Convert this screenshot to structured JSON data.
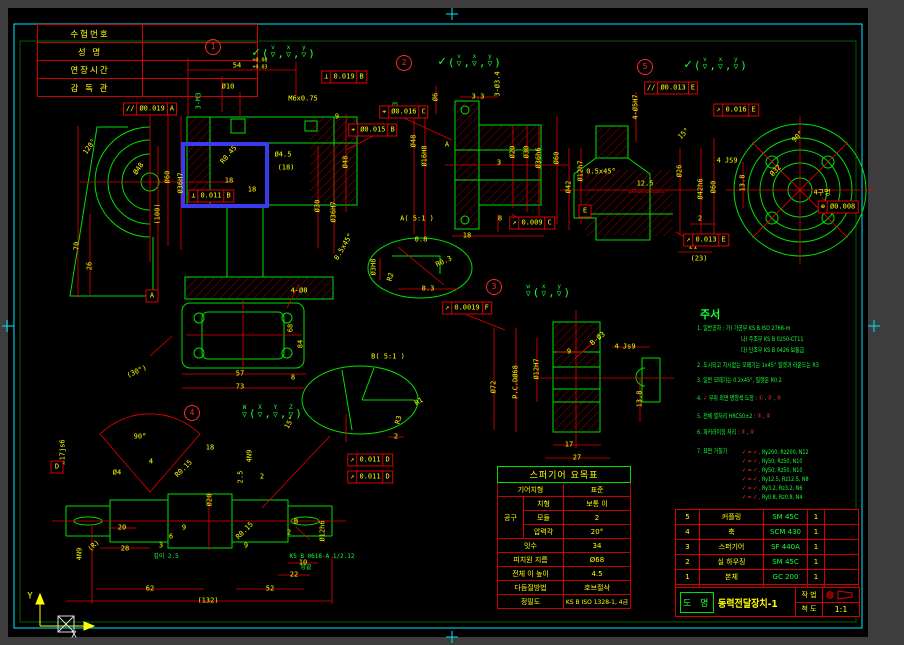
{
  "sheet": {
    "outer_bg": "#3d3d3d",
    "paper_bg": "#000000",
    "frame_color": "#00e5ff",
    "geometry_color": "#00e000",
    "dimension_color": "#e60000",
    "text_color": "#ffff00",
    "note_color": "#15ff35",
    "highlight_color": "#3a3aee"
  },
  "exam_table": {
    "rows": [
      {
        "label": "수험번호",
        "value": ""
      },
      {
        "label": "성  명",
        "value": ""
      },
      {
        "label": "연장시간",
        "value": ""
      },
      {
        "label": "감 독 관",
        "value": ""
      }
    ]
  },
  "ucs": {
    "y_label": "Y",
    "x_label": "X"
  },
  "notes": {
    "title": "주서",
    "title_x": 700,
    "title_y": 314,
    "lines": [
      {
        "t": "1. 일반공차 : 가) 가공부 KS B ISO 2768-m",
        "x": 697,
        "y": 328
      },
      {
        "t": "나) 주조부 KS B 0250-CT11",
        "x": 741,
        "y": 339
      },
      {
        "t": "다) 단조부 KS B 0426 보통급",
        "x": 741,
        "y": 350
      },
      {
        "t": "2. 도시되고 지시없는 모떼기는 1x45° 필렛과 라운드는 R3",
        "x": 697,
        "y": 365
      },
      {
        "t": "3. 일반 모떼기는 0.2x45°, 필렛은 R0.2",
        "x": 697,
        "y": 380
      },
      {
        "t": "4. ✓ 부위 외면 명청색 도장 : ① , ② , ③",
        "x": 697,
        "y": 398
      },
      {
        "t": "5. 전체 열처리 HRC50±2 : ③ , ④",
        "x": 697,
        "y": 416
      },
      {
        "t": "6. 파커라이징 처리 : ③ , ④",
        "x": 697,
        "y": 432
      },
      {
        "t": "7. 표면 거칠기",
        "x": 697,
        "y": 451
      }
    ],
    "roughness": [
      {
        "sym": "✓ = ✓ ,",
        "val": "Ry200, Rz200, N12",
        "x": 742,
        "y": 452
      },
      {
        "sym": "✓ = ✓ ,",
        "val": "Ry50,  Rz50,  N10",
        "x": 742,
        "y": 461
      },
      {
        "sym": "✓ = ✓ ,",
        "val": "Ry50,  Rz50,  N10",
        "x": 742,
        "y": 470
      },
      {
        "sym": "✓ = ✓ ,",
        "val": "Ry12.5, Rz12.5, N8",
        "x": 742,
        "y": 479
      },
      {
        "sym": "✓ = ✓ ,",
        "val": "Ry3.2, Rz3.2, N6",
        "x": 742,
        "y": 488
      },
      {
        "sym": "✓ = ✓ ,",
        "val": "Ry0.8, Rz0.8, N4",
        "x": 742,
        "y": 497
      }
    ]
  },
  "gear_table": {
    "title": "스퍼기어 요목표",
    "type_label": "기어치형",
    "type_value": "표준",
    "tool_label": "공구",
    "tooth_label": "치형",
    "tooth_value": "보통 이",
    "module_label": "모듈",
    "module_value": "2",
    "pressure_label": "압력각",
    "pressure_value": "20°",
    "teeth_label": "잇수",
    "teeth_value": "34",
    "pcd_label": "피치원 지름",
    "pcd_value": "Ø68",
    "height_label": "전체 이 높이",
    "height_value": "4.5",
    "finish_label": "다듬질방법",
    "finish_value": "호브절삭",
    "precision_label": "정밀도",
    "precision_value": "KS B ISO 1328-1, 4급"
  },
  "bom": {
    "headers": [
      "품 번",
      "품 명",
      "재 질",
      "수 량",
      "비 고"
    ],
    "items": [
      {
        "no": "5",
        "name": "커플링",
        "mat": "SM 45C",
        "qty": "1",
        "remark": ""
      },
      {
        "no": "4",
        "name": "축",
        "mat": "SCM 430",
        "qty": "1",
        "remark": ""
      },
      {
        "no": "3",
        "name": "스퍼기어",
        "mat": "SF 440A",
        "qty": "1",
        "remark": ""
      },
      {
        "no": "2",
        "name": "실 하우징",
        "mat": "SM 45C",
        "qty": "1",
        "remark": ""
      },
      {
        "no": "1",
        "name": "본체",
        "mat": "GC 200",
        "qty": "1",
        "remark": ""
      }
    ],
    "drawing_name_label": "도 명",
    "drawing_name": "동력전달장치-1",
    "method_label": "작 법",
    "scale_label": "척 도",
    "scale_value": "1:1"
  },
  "views": [
    {
      "name": "view-1",
      "balloon": {
        "n": "1",
        "x": 213,
        "y": 47
      },
      "finish": {
        "x": 284,
        "y": 52,
        "base": "",
        "letters": [
          "v",
          "x",
          "y"
        ]
      },
      "datums": [
        {
          "t": "A",
          "x": 152,
          "y": 296
        }
      ],
      "fcf": [
        {
          "x": 344,
          "y": 77,
          "cells": [
            "⊥",
            "0.019",
            "B"
          ]
        },
        {
          "x": 150,
          "y": 109,
          "cells": [
            "//",
            "Ø0.019",
            "A"
          ]
        },
        {
          "x": 373,
          "y": 130,
          "cells": [
            "⌖",
            "Ø0.015",
            "B"
          ]
        },
        {
          "x": 211,
          "y": 196,
          "cells": [
            "⊥",
            "0.011",
            "B"
          ]
        }
      ],
      "labels": [
        {
          "t": "54",
          "x": 237,
          "y": 66
        },
        {
          "t": "+0.08",
          "x": 260,
          "y": 61,
          "s": 5
        },
        {
          "t": "+0.03",
          "x": 260,
          "y": 68,
          "s": 5
        },
        {
          "t": "Ø10",
          "x": 228,
          "y": 87
        },
        {
          "t": "M6x0.75",
          "x": 303,
          "y": 99
        },
        {
          "t": "9",
          "x": 337,
          "y": 117
        },
        {
          "t": "3-M3",
          "x": 199,
          "y": 101,
          "r": -90,
          "c": "g"
        },
        {
          "t": "M3",
          "x": 396,
          "y": 106,
          "r": -90,
          "c": "g"
        },
        {
          "t": "120°",
          "x": 90,
          "y": 147,
          "r": -55
        },
        {
          "t": "Ø48",
          "x": 139,
          "y": 169,
          "r": -55
        },
        {
          "t": "Ø60",
          "x": 168,
          "y": 177,
          "r": -90
        },
        {
          "t": "Ø36H7",
          "x": 181,
          "y": 183,
          "r": -90
        },
        {
          "t": "(100)",
          "x": 158,
          "y": 214,
          "r": -90
        },
        {
          "t": "70",
          "x": 77,
          "y": 246,
          "r": -90
        },
        {
          "t": "26",
          "x": 90,
          "y": 266,
          "r": -90
        },
        {
          "t": "R0.45",
          "x": 229,
          "y": 155,
          "r": -50
        },
        {
          "t": "18",
          "x": 229,
          "y": 181
        },
        {
          "t": "18",
          "x": 252,
          "y": 190
        },
        {
          "t": "Ø4.5",
          "x": 283,
          "y": 155
        },
        {
          "t": "(18)",
          "x": 286,
          "y": 168
        },
        {
          "t": "Ø30",
          "x": 318,
          "y": 206,
          "r": -90
        },
        {
          "t": "Ø36H7",
          "x": 334,
          "y": 212,
          "r": -90
        },
        {
          "t": "Ø48",
          "x": 346,
          "y": 162,
          "r": -90
        },
        {
          "t": "0.5x45°",
          "x": 344,
          "y": 247,
          "r": -60
        },
        {
          "t": "4-Ø8",
          "x": 299,
          "y": 291
        },
        {
          "t": "(30°)",
          "x": 137,
          "y": 372,
          "r": -25
        },
        {
          "t": "57",
          "x": 240,
          "y": 374
        },
        {
          "t": "73",
          "x": 240,
          "y": 387
        },
        {
          "t": "68",
          "x": 291,
          "y": 328,
          "r": -90
        },
        {
          "t": "84",
          "x": 301,
          "y": 344,
          "r": -90
        },
        {
          "t": "8",
          "x": 293,
          "y": 378
        }
      ]
    },
    {
      "name": "view-2",
      "balloon": {
        "n": "2",
        "x": 404,
        "y": 63
      },
      "finish": {
        "x": 470,
        "y": 61,
        "base": "",
        "letters": [
          "v",
          "x",
          "y"
        ]
      },
      "datums": [],
      "fcf": [
        {
          "x": 404,
          "y": 112,
          "cells": [
            "⌖",
            "Ø0.016",
            "C"
          ]
        },
        {
          "x": 532,
          "y": 223,
          "cells": [
            "↗",
            "0.009",
            "C"
          ]
        }
      ],
      "labels": [
        {
          "t": "Ø6",
          "x": 436,
          "y": 97,
          "r": -90
        },
        {
          "t": "3.3",
          "x": 478,
          "y": 97
        },
        {
          "t": "3-Ø3.4",
          "x": 498,
          "y": 84,
          "r": -90
        },
        {
          "t": "Ø48",
          "x": 414,
          "y": 141,
          "r": -90
        },
        {
          "t": "Ø16H8",
          "x": 425,
          "y": 156,
          "r": -90
        },
        {
          "t": "Ø20",
          "x": 513,
          "y": 152,
          "r": -90
        },
        {
          "t": "Ø30",
          "x": 527,
          "y": 152,
          "r": -90
        },
        {
          "t": "Ø36h6",
          "x": 539,
          "y": 158,
          "r": -90
        },
        {
          "t": "Ø60",
          "x": 557,
          "y": 158,
          "r": -90
        },
        {
          "t": "3",
          "x": 499,
          "y": 163
        },
        {
          "t": "A",
          "x": 447,
          "y": 145
        },
        {
          "t": "18",
          "x": 467,
          "y": 236
        },
        {
          "t": "8",
          "x": 500,
          "y": 219
        }
      ]
    },
    {
      "name": "view-3",
      "balloon": {
        "n": "3",
        "x": 494,
        "y": 287
      },
      "finish": {
        "x": 548,
        "y": 291,
        "base": "w",
        "letters": [
          "x",
          "y"
        ]
      },
      "datums": [],
      "fcf": [
        {
          "x": 467,
          "y": 308,
          "cells": [
            "↗",
            "0.0019",
            "F"
          ]
        }
      ],
      "labels": [
        {
          "t": "Ø72",
          "x": 494,
          "y": 387,
          "r": -90
        },
        {
          "t": "P.C.DØ68",
          "x": 516,
          "y": 382,
          "r": -90
        },
        {
          "t": "Ø12H7",
          "x": 537,
          "y": 369,
          "r": -90
        },
        {
          "t": "9",
          "x": 569,
          "y": 352
        },
        {
          "t": "B-Ø3",
          "x": 598,
          "y": 339,
          "r": -40
        },
        {
          "t": "4 Js9",
          "x": 625,
          "y": 347
        },
        {
          "t": "13.8",
          "x": 640,
          "y": 399,
          "r": -90
        },
        {
          "t": "17",
          "x": 569,
          "y": 445
        },
        {
          "t": "27",
          "x": 577,
          "y": 458
        }
      ]
    },
    {
      "name": "view-4",
      "balloon": {
        "n": "4",
        "x": 192,
        "y": 413
      },
      "finish": {
        "x": 272,
        "y": 412,
        "base": "W",
        "letters": [
          "X",
          "Y",
          "Z"
        ]
      },
      "datums": [
        {
          "t": "D",
          "x": 57,
          "y": 467
        }
      ],
      "fcf": [
        {
          "x": 370,
          "y": 460,
          "cells": [
            "↗",
            "0.011",
            "D"
          ]
        },
        {
          "x": 370,
          "y": 477,
          "cells": [
            "↗",
            "0.011",
            "D"
          ]
        }
      ],
      "labels": [
        {
          "t": "90°",
          "x": 140,
          "y": 437
        },
        {
          "t": "Ø4",
          "x": 117,
          "y": 473
        },
        {
          "t": "4",
          "x": 151,
          "y": 462
        },
        {
          "t": "R0.15",
          "x": 184,
          "y": 469,
          "r": -45
        },
        {
          "t": "18",
          "x": 210,
          "y": 448
        },
        {
          "t": "4N9",
          "x": 250,
          "y": 456,
          "r": -90
        },
        {
          "t": "2.5",
          "x": 241,
          "y": 477,
          "r": -90
        },
        {
          "t": "2",
          "x": 262,
          "y": 477
        },
        {
          "t": "15°",
          "x": 290,
          "y": 423,
          "r": -60
        },
        {
          "t": "Ø20",
          "x": 210,
          "y": 500,
          "r": -90
        },
        {
          "t": "Ø17js6",
          "x": 63,
          "y": 452,
          "r": -90
        },
        {
          "t": "4N9",
          "x": 80,
          "y": 554,
          "r": -90
        },
        {
          "t": "(R)",
          "x": 94,
          "y": 546,
          "r": -45
        },
        {
          "t": "20",
          "x": 122,
          "y": 528
        },
        {
          "t": "28",
          "x": 125,
          "y": 549
        },
        {
          "t": "9",
          "x": 184,
          "y": 528
        },
        {
          "t": "6",
          "x": 171,
          "y": 537
        },
        {
          "t": "3",
          "x": 161,
          "y": 546
        },
        {
          "t": "깊이 2.5",
          "x": 166,
          "y": 557,
          "c": "g",
          "s": 6
        },
        {
          "t": "R0.15",
          "x": 245,
          "y": 531,
          "r": -45
        },
        {
          "t": "9",
          "x": 246,
          "y": 546
        },
        {
          "t": "2",
          "x": 289,
          "y": 533
        },
        {
          "t": "B",
          "x": 296,
          "y": 522
        },
        {
          "t": "10",
          "x": 303,
          "y": 563
        },
        {
          "t": "22",
          "x": 294,
          "y": 575
        },
        {
          "t": "62",
          "x": 150,
          "y": 589
        },
        {
          "t": "52",
          "x": 270,
          "y": 589
        },
        {
          "t": "(132)",
          "x": 208,
          "y": 601
        },
        {
          "t": "KS B 0618-A 1/2.12",
          "x": 322,
          "y": 557,
          "c": "g",
          "s": 6
        },
        {
          "t": "양끝",
          "x": 306,
          "y": 568,
          "c": "g",
          "s": 6
        },
        {
          "t": "Ø12h6",
          "x": 323,
          "y": 531,
          "r": -90
        }
      ]
    },
    {
      "name": "view-5",
      "balloon": {
        "n": "5",
        "x": 645,
        "y": 67
      },
      "finish": {
        "x": 716,
        "y": 64,
        "base": "",
        "letters": [
          "v",
          "x",
          "y"
        ]
      },
      "datums": [
        {
          "t": "E",
          "x": 585,
          "y": 211
        }
      ],
      "fcf": [
        {
          "x": 671,
          "y": 88,
          "cells": [
            "//",
            "Ø0.013",
            "E"
          ]
        },
        {
          "x": 736,
          "y": 110,
          "cells": [
            "↗",
            "0.016",
            "E"
          ]
        },
        {
          "x": 838,
          "y": 207,
          "cells": [
            "⊕",
            "Ø0.008"
          ]
        },
        {
          "x": 706,
          "y": 240,
          "cells": [
            "↗",
            "0.013",
            "E"
          ]
        }
      ],
      "labels": [
        {
          "t": "4-Ø5H7",
          "x": 636,
          "y": 107,
          "r": -90
        },
        {
          "t": "15°",
          "x": 684,
          "y": 134,
          "r": -45
        },
        {
          "t": "Ø42",
          "x": 569,
          "y": 187,
          "r": -90
        },
        {
          "t": "Ø12h7",
          "x": 581,
          "y": 171,
          "r": -90
        },
        {
          "t": "0.5x45°",
          "x": 601,
          "y": 172
        },
        {
          "t": "12.5",
          "x": 645,
          "y": 184
        },
        {
          "t": "Ø26",
          "x": 680,
          "y": 171,
          "r": -90
        },
        {
          "t": "Ø42h6",
          "x": 701,
          "y": 189,
          "r": -90
        },
        {
          "t": "Ø60",
          "x": 714,
          "y": 187,
          "r": -90
        },
        {
          "t": "4 JS9",
          "x": 727,
          "y": 161
        },
        {
          "t": "13.8",
          "x": 743,
          "y": 183,
          "r": -90
        },
        {
          "t": "Ø32",
          "x": 776,
          "y": 171,
          "r": -45
        },
        {
          "t": "90°",
          "x": 798,
          "y": 137,
          "r": -45
        },
        {
          "t": "4구멍",
          "x": 822,
          "y": 193
        },
        {
          "t": "2",
          "x": 700,
          "y": 219
        },
        {
          "t": "21",
          "x": 693,
          "y": 247
        },
        {
          "t": "(23)",
          "x": 699,
          "y": 259
        }
      ]
    },
    {
      "name": "detail-a",
      "labels": [
        {
          "t": "A( 5:1 )",
          "x": 417,
          "y": 219
        },
        {
          "t": "0.8",
          "x": 421,
          "y": 240
        },
        {
          "t": "R0.3",
          "x": 444,
          "y": 262,
          "r": -25
        },
        {
          "t": "R2",
          "x": 391,
          "y": 277,
          "r": -75
        },
        {
          "t": "8.3",
          "x": 428,
          "y": 289
        },
        {
          "t": "Ø3H8",
          "x": 374,
          "y": 267,
          "r": -90
        }
      ]
    },
    {
      "name": "detail-b",
      "labels": [
        {
          "t": "B( 5:1 )",
          "x": 388,
          "y": 357
        },
        {
          "t": "R1",
          "x": 419,
          "y": 402,
          "r": -30
        },
        {
          "t": "R3",
          "x": 399,
          "y": 420,
          "r": -75
        },
        {
          "t": "2",
          "x": 396,
          "y": 437
        }
      ]
    },
    {
      "name": "ucs-icon",
      "labels": [
        {
          "t": "Y",
          "x": 30,
          "y": 597,
          "c": "y",
          "s": 9
        },
        {
          "t": "X",
          "x": 74,
          "y": 636,
          "c": "w",
          "s": 9
        }
      ]
    }
  ]
}
